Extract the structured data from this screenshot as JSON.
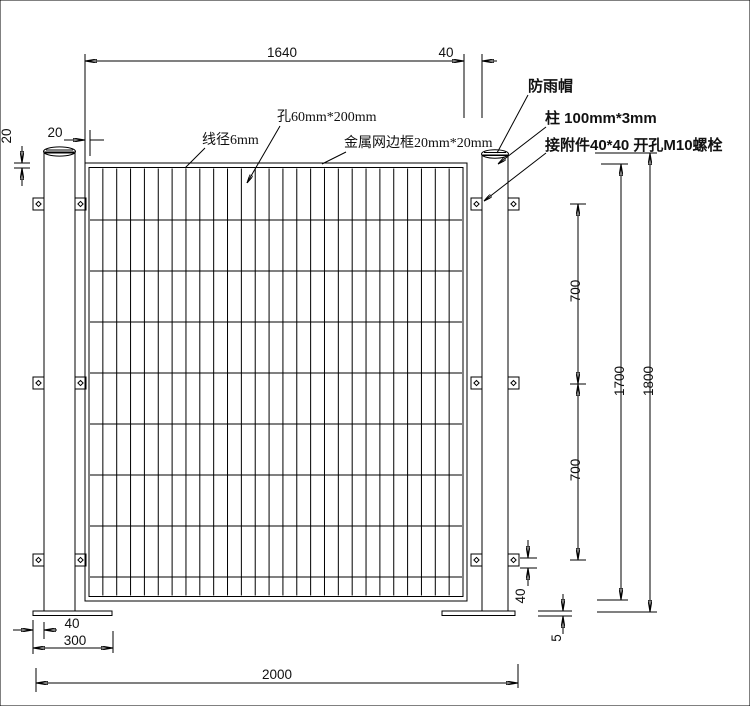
{
  "drawing_type": "fence-panel-technical-drawing",
  "colors": {
    "line": "#000000",
    "background": "#ffffff"
  },
  "dimensions": {
    "mesh_width": "1640",
    "panel_post_gap": "40",
    "frame_section_width": "20",
    "frame_section_height": "20",
    "bracket_spacing_upper": "700",
    "bracket_spacing_lower": "700",
    "mesh_height": "1700",
    "post_height": "1800",
    "bracket_size": "40",
    "plate_thickness": "5",
    "plate_edge_offset": "40",
    "plate_width": "300",
    "overall_width": "2000"
  },
  "callouts": {
    "wire_diameter": "线径6mm",
    "mesh_hole": "孔60mm*200mm",
    "mesh_frame": "金属网边框20mm*20mm",
    "rain_cap": "防雨帽",
    "post_spec": "柱 100mm*3mm",
    "bracket_spec": "接附件40*40 开孔M10螺栓"
  },
  "mesh": {
    "columns": 27,
    "wire_rows": 8
  }
}
